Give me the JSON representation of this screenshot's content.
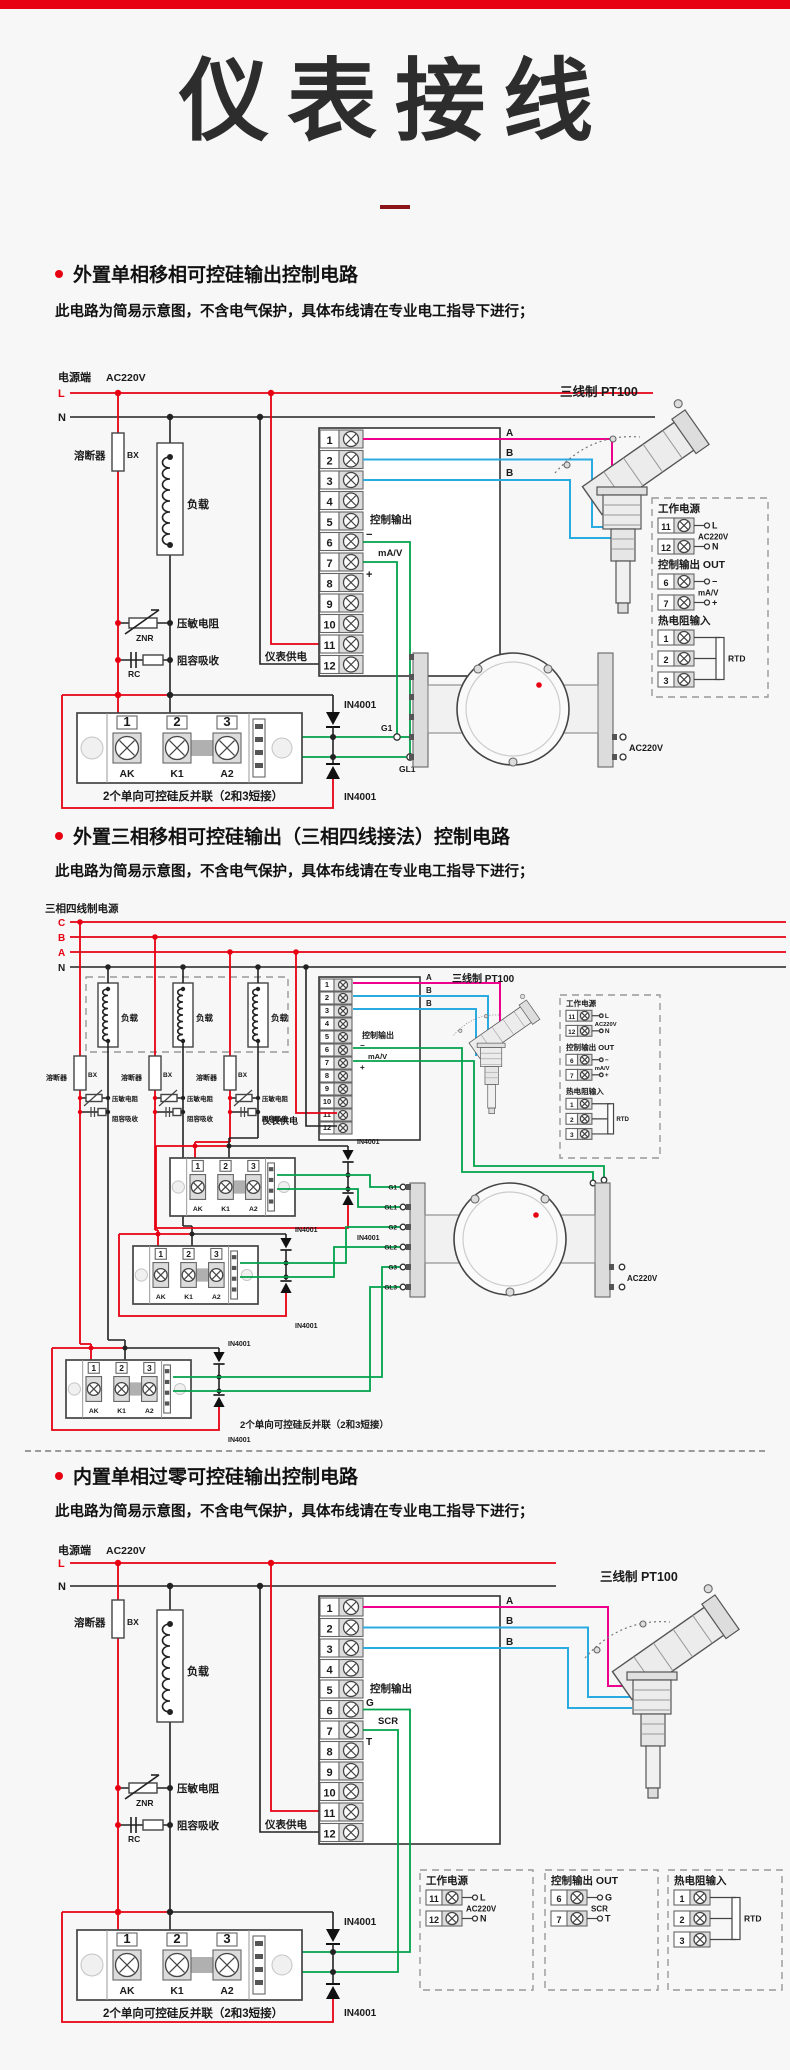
{
  "page": {
    "title": "仪表接线",
    "accent": "#e60012",
    "divider_color": "#8b1518"
  },
  "note": "此电路为简易示意图，不含电气保护，具体布线请在专业电工指导下进行；",
  "sections": [
    {
      "heading": "外置单相移相可控硅输出控制电路"
    },
    {
      "heading": "外置三相移相可控硅输出（三相四线接法）控制电路"
    },
    {
      "heading": "内置单相过零可控硅输出控制电路"
    }
  ],
  "labels": {
    "power_end": "电源端",
    "ac220v": "AC220V",
    "l": "L",
    "n": "N",
    "three_phase": "三相四线制电源",
    "c": "C",
    "b": "B",
    "a": "A",
    "fuse": "溶断器",
    "bx": "BX",
    "load": "负载",
    "varistor": "压敏电阻",
    "znr": "ZNR",
    "rc_name": "阻容吸收",
    "rc": "RC",
    "in4001": "IN4001",
    "meter_supply": "仪表供电",
    "ctrl_out": "控制输出",
    "minus": "−",
    "plus": "+",
    "ma_v": "mA/V",
    "pt100": "三线制 PT100",
    "module_note": "2个单向可控硅反并联（2和3短接）",
    "g": "G",
    "scr": "SCR",
    "t": "T",
    "g1": "G1",
    "gl1": "GL1"
  },
  "terminals": [
    "1",
    "2",
    "3",
    "4",
    "5",
    "6",
    "7",
    "8",
    "9",
    "10",
    "11",
    "12"
  ],
  "module": {
    "nums": [
      "1",
      "2",
      "3"
    ],
    "pins": [
      "AK",
      "K1",
      "A2"
    ]
  },
  "gate_pins": [
    "G1",
    "GL1",
    "G2",
    "GL2",
    "G3",
    "GL3"
  ],
  "connector_groups": {
    "wp": {
      "title": "工作电源",
      "rows": [
        {
          "n": "11",
          "tag": "L"
        },
        {
          "n": "12",
          "tag": "N"
        }
      ],
      "sub": "AC220V"
    },
    "co": {
      "title": "控制输出 OUT",
      "rows": [
        {
          "n": "6",
          "tag": "−"
        },
        {
          "n": "7",
          "tag": "+"
        }
      ],
      "sub": "mA/V"
    },
    "co3": {
      "title": "控制输出 OUT",
      "rows": [
        {
          "n": "6",
          "tag": "G"
        },
        {
          "n": "7",
          "tag": "T"
        }
      ],
      "sub": "SCR"
    },
    "ri": {
      "title": "热电阻输入",
      "rows": [
        {
          "n": "1"
        },
        {
          "n": "2"
        },
        {
          "n": "3"
        }
      ],
      "sub": "RTD"
    }
  }
}
